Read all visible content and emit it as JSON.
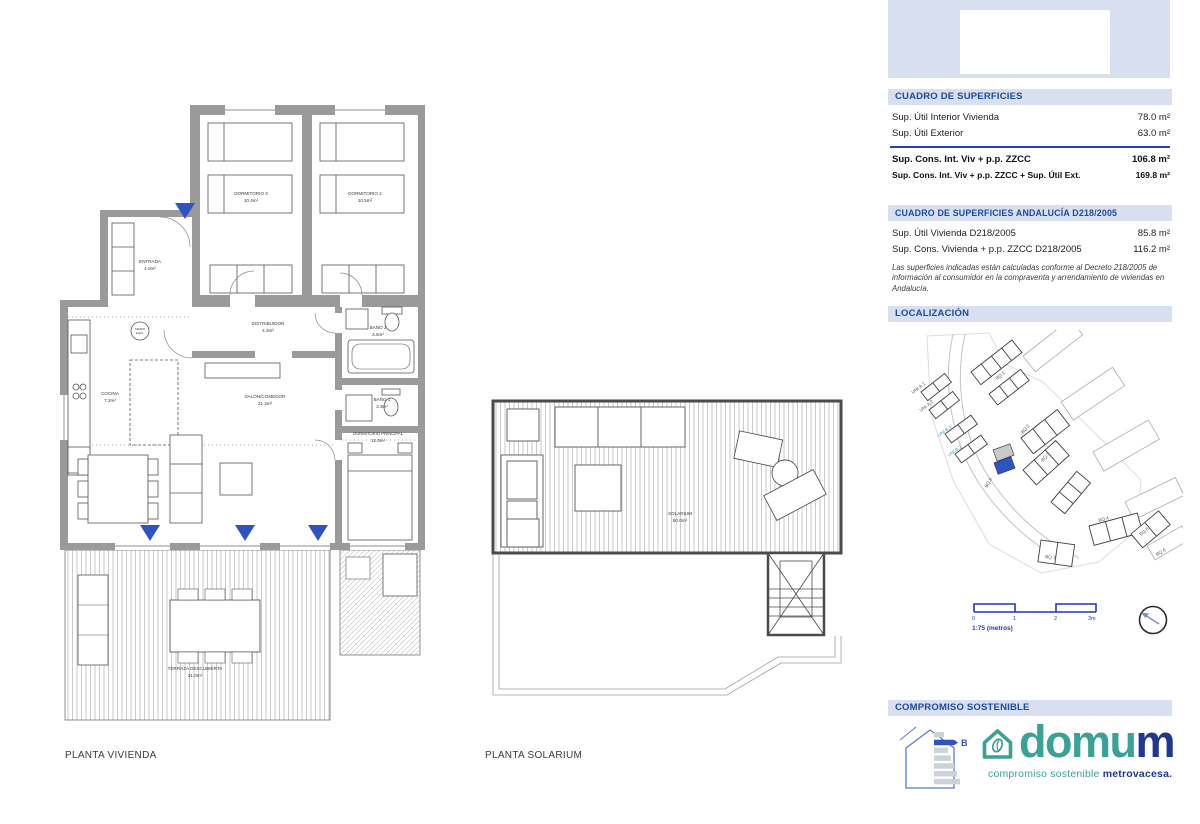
{
  "colors": {
    "panel_header_bg": "#d8dff1",
    "panel_header_text": "#1a4a9c",
    "divider_blue": "#2740b5",
    "scale_blue": "#2236b5",
    "highlight_blue": "#2f54c0",
    "wall_gray": "#9a9a9a",
    "teal": "#3aa195",
    "navy": "#1f3790"
  },
  "floor_plans": {
    "vivienda": {
      "caption": "PLANTA VIVIENDA",
      "rooms": {
        "dormitorio3": {
          "name": "DORMITORIO 3",
          "area": "10.4m²"
        },
        "dormitorio2": {
          "name": "DORMITORIO 2",
          "area": "10.5m²"
        },
        "entrada": {
          "name": "ENTRADA",
          "area": "4.0m²"
        },
        "distribuidor": {
          "name": "DISTRIBUIDOR",
          "area": "4.3m²"
        },
        "bano2": {
          "name": "BAÑO 2",
          "area": "3.5m²"
        },
        "cocina": {
          "name": "COCINA",
          "area": "7.2m²"
        },
        "salon": {
          "name": "SALÓN/COMEDOR",
          "area": "21.4m²"
        },
        "bano1": {
          "name": "BAÑO 1",
          "area": "3.3m²"
        },
        "principal": {
          "name": "DORMITORIO PRINCIPAL",
          "area": "12.0m²"
        },
        "terraza": {
          "name": "TERRAZA DESCUBIERTA",
          "area": "31.0m²"
        },
        "termo": {
          "name": "TERMO",
          "area": "ELEC."
        }
      }
    },
    "solarium": {
      "caption": "PLANTA SOLARIUM",
      "rooms": {
        "solarium": {
          "name": "SOLARIUM",
          "area": "50.0m²"
        }
      }
    }
  },
  "sidebar": {
    "superficies": {
      "title": "CUADRO DE SUPERFICIES",
      "rows": [
        {
          "label": "Sup. Útil Interior Vivienda",
          "value": "78.0 m²"
        },
        {
          "label": "Sup. Útil Exterior",
          "value": "63.0 m²"
        }
      ],
      "totals": [
        {
          "label": "Sup. Cons. Int. Viv + p.p. ZZCC",
          "value": "106.8 m²"
        },
        {
          "label": "Sup. Cons. Int. Viv + p.p. ZZCC + Sup. Útil Ext.",
          "value": "169.8 m²"
        }
      ]
    },
    "andalucia": {
      "title": "CUADRO DE SUPERFICIES ANDALUCÍA D218/2005",
      "rows": [
        {
          "label": "Sup. Útil Vivienda D218/2005",
          "value": "85.8 m²"
        },
        {
          "label": "Sup. Cons. Vivienda + p.p. ZZCC D218/2005",
          "value": "116.2 m²"
        }
      ],
      "note": "Las superficies indicadas están calculadas conforme al Decreto 218/2005 de información al consumidor en la compraventa y arrendamiento de viviendas en Andalucía."
    },
    "localizacion": {
      "title": "LOCALIZACIÓN",
      "map_labels": [
        "BQ.1",
        "BQ.2",
        "BQ.3",
        "BQ.4",
        "BQ.5",
        "BQ.6",
        "BQ.7",
        "BQ.8",
        "UNI.A.1",
        "UNI.A.2",
        "UNI.B.1",
        "UNI.B.2"
      ],
      "scale": {
        "ticks": [
          "0",
          "1",
          "2",
          "3m"
        ],
        "caption": "1:75 (metros)"
      }
    },
    "compromiso": {
      "title": "COMPROMISO SOSTENIBLE",
      "energy_rating": "B",
      "brand_main": "domu",
      "brand_m": "m",
      "tagline_1": "compromiso sostenible ",
      "tagline_2": "metrovacesa."
    }
  }
}
